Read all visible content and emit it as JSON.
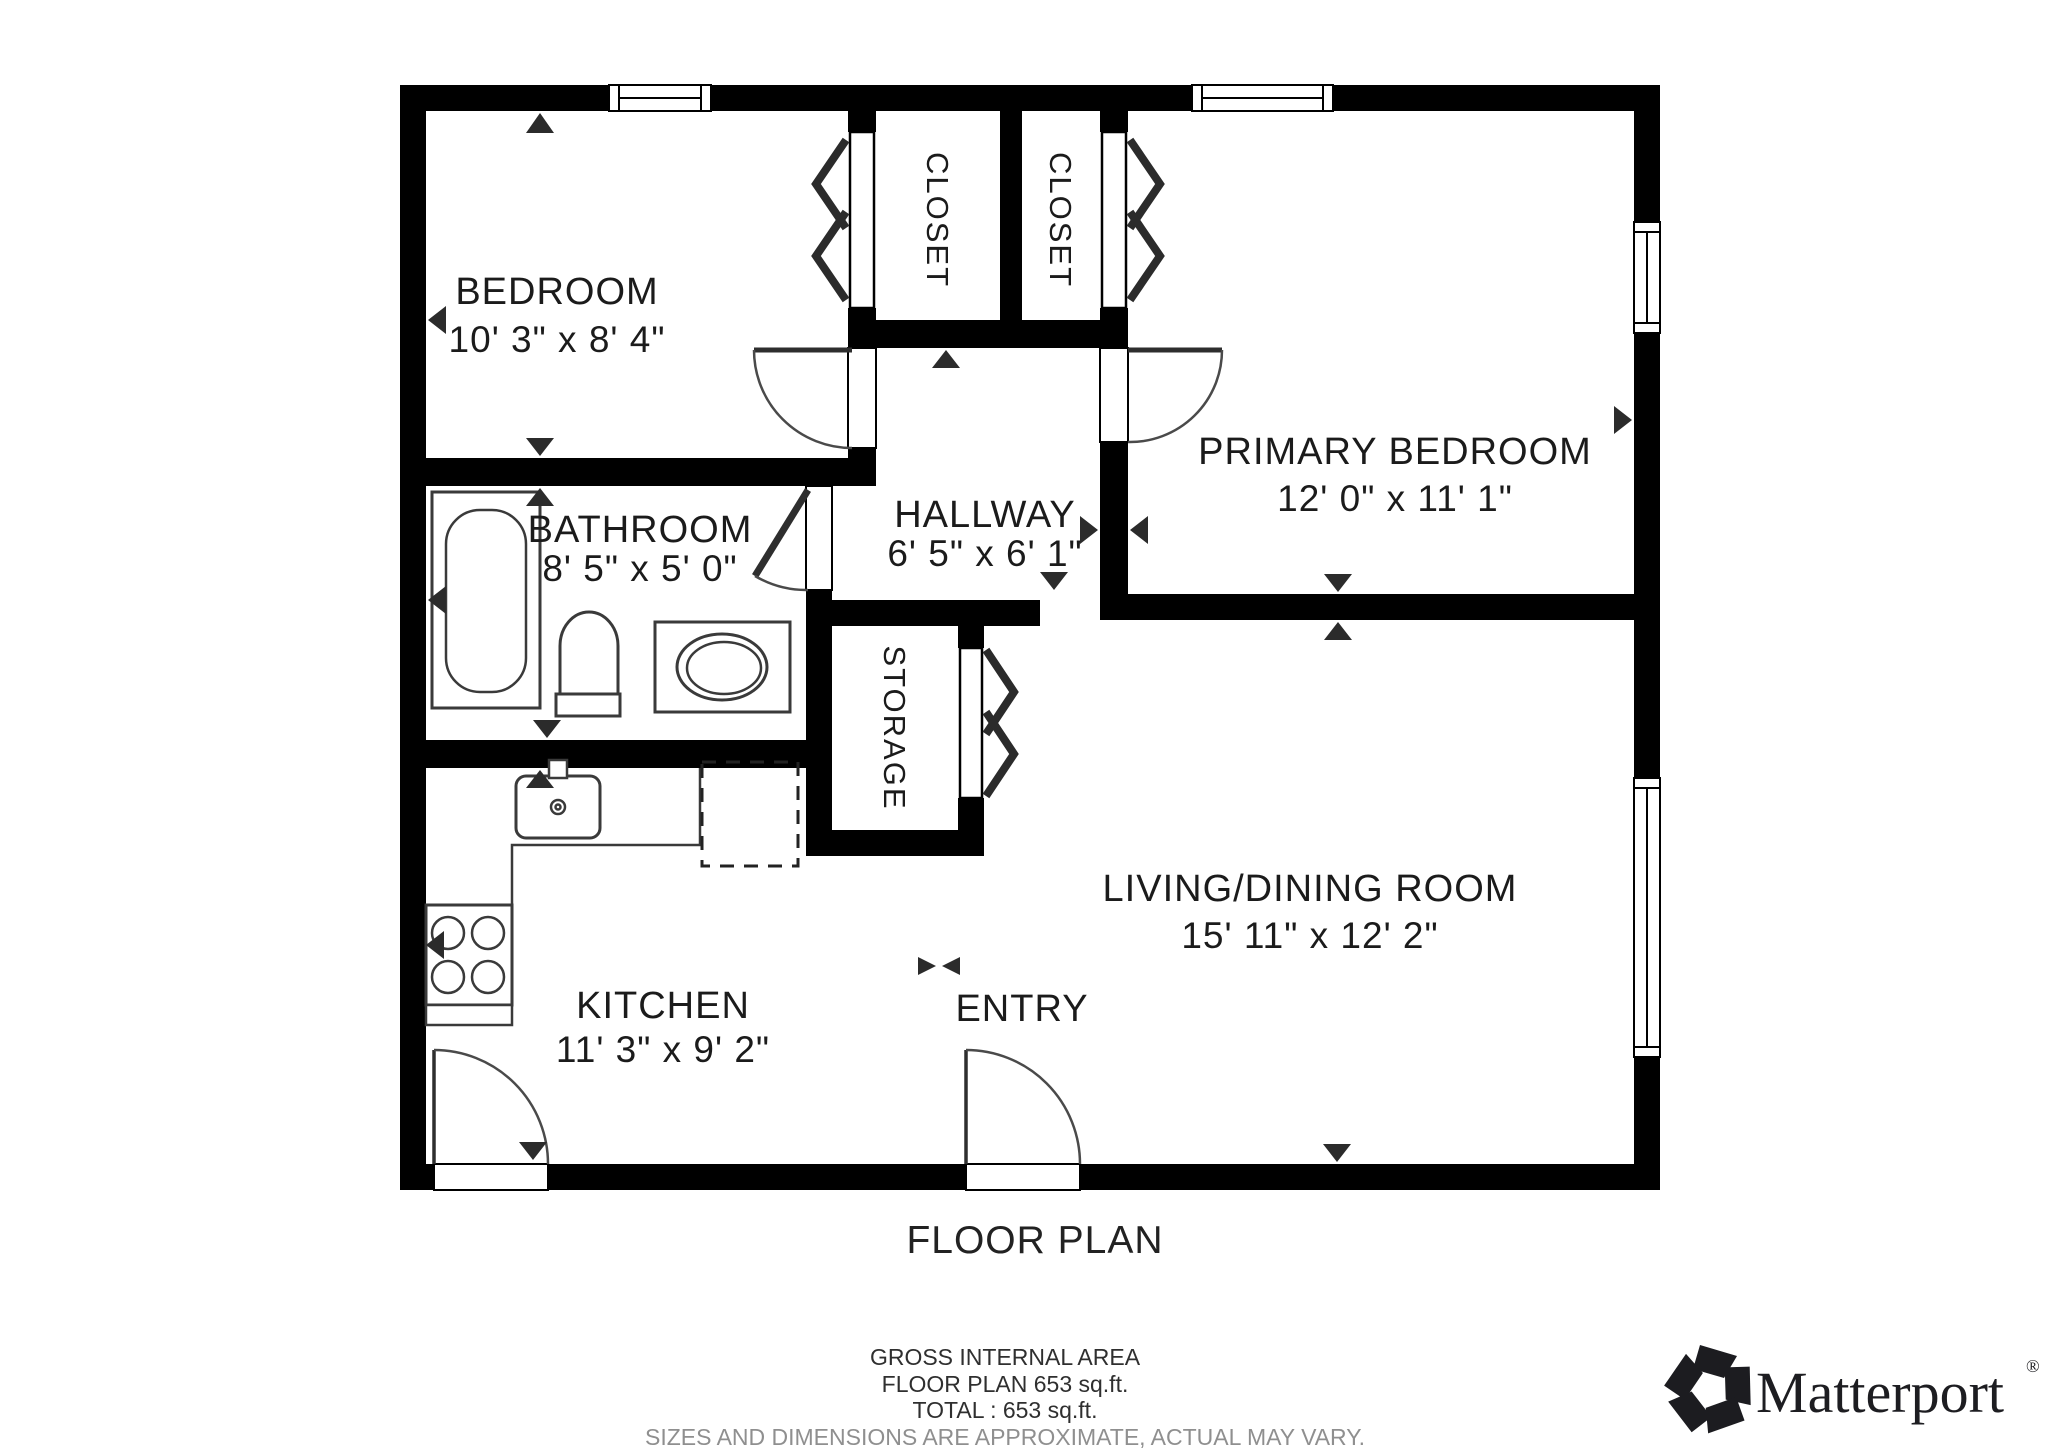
{
  "floor_plan": {
    "title": "FLOOR PLAN",
    "rooms": [
      {
        "id": "bedroom",
        "name": "BEDROOM",
        "dims": "10' 3\" x 8' 4\""
      },
      {
        "id": "closet_left",
        "name": "CLOSET"
      },
      {
        "id": "closet_right",
        "name": "CLOSET"
      },
      {
        "id": "primary_bedroom",
        "name": "PRIMARY BEDROOM",
        "dims": "12' 0\" x 11' 1\""
      },
      {
        "id": "hallway",
        "name": "HALLWAY",
        "dims": "6' 5\" x 6' 1\""
      },
      {
        "id": "bathroom",
        "name": "BATHROOM",
        "dims": "8' 5\" x 5' 0\""
      },
      {
        "id": "storage",
        "name": "STORAGE"
      },
      {
        "id": "kitchen",
        "name": "KITCHEN",
        "dims": "11' 3\" x 9' 2\""
      },
      {
        "id": "living_dining",
        "name": "LIVING/DINING ROOM",
        "dims": "15' 11\" x 12' 2\""
      },
      {
        "id": "entry",
        "name": "ENTRY"
      }
    ]
  },
  "footer": {
    "area_heading": "GROSS INTERNAL AREA",
    "area_line1": "FLOOR PLAN 653 sq.ft.",
    "area_line2": "TOTAL :  653 sq.ft.",
    "total_sqft": 653,
    "disclaimer": "SIZES AND DIMENSIONS ARE APPROXIMATE, ACTUAL MAY VARY."
  },
  "brand": {
    "name": "Matterport",
    "registered": "®"
  },
  "colors": {
    "wall": "#000000",
    "background": "#ffffff",
    "label": "#1b1b1b",
    "disclaimer_gray": "#8f8f8f",
    "fixture": "#3a3a3a",
    "marker": "#2b2b2b"
  }
}
